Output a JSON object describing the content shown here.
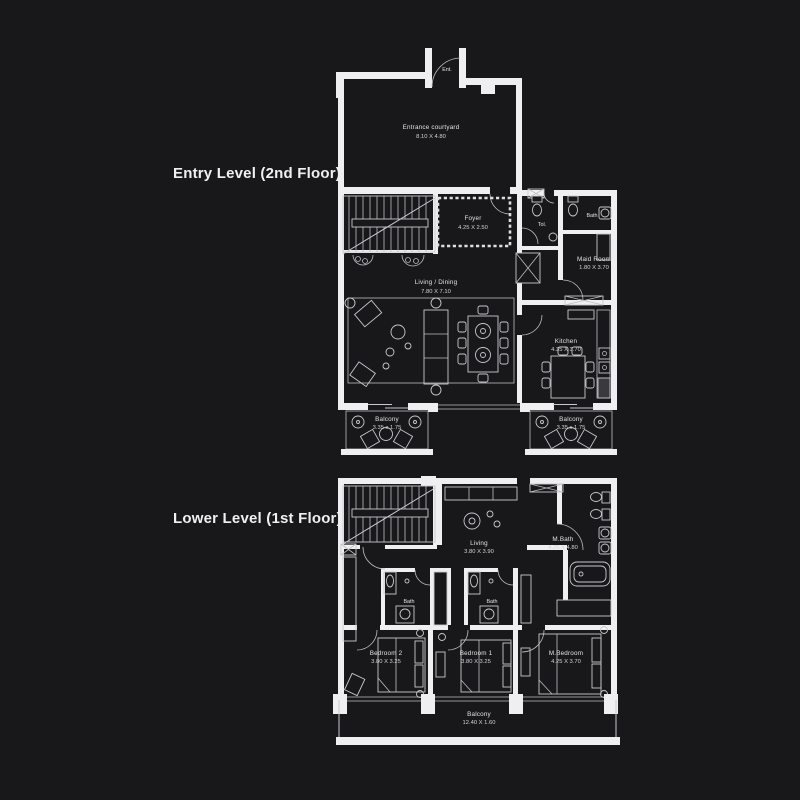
{
  "page": {
    "background": "#18181b",
    "colors": {
      "wall": "#efeff1",
      "line": "#c9c9cd",
      "text": "#e3e3e5"
    }
  },
  "entry": {
    "title": "Entry Level (2nd Floor)",
    "entrance_door": "Ent.",
    "courtyard": {
      "name": "Entrance courtyard",
      "dims": "8.10 X 4.80"
    },
    "foyer": {
      "name": "Foyer",
      "dims": "4.25 X 2.50"
    },
    "toilet": {
      "name": "Tol."
    },
    "bath": {
      "name": "Bath"
    },
    "maid": {
      "name": "Maid Room",
      "dims": "1.80 X 3.70"
    },
    "living": {
      "name": "Living / Dining",
      "dims": "7.80 X 7.10"
    },
    "kitchen": {
      "name": "Kitchen",
      "dims": "4.35 X 3.70"
    },
    "balcony_left": {
      "name": "Balcony",
      "dims": "3.35 x 1.75"
    },
    "balcony_right": {
      "name": "Balcony",
      "dims": "3.35 x 1.75"
    }
  },
  "lower": {
    "title": "Lower Level (1st Floor)",
    "living": {
      "name": "Living",
      "dims": "3.80 X 3.90"
    },
    "mbath": {
      "name": "M.Bath",
      "dims": "4.25 X 4.80"
    },
    "bath1": {
      "name": "Bath"
    },
    "bath2": {
      "name": "Bath"
    },
    "bedroom2": {
      "name": "Bedroom 2",
      "dims": "3.80 X 3.25"
    },
    "bedroom1": {
      "name": "Bedroom 1",
      "dims": "3.80 X 3.25"
    },
    "mbedroom": {
      "name": "M.Bedroom",
      "dims": "4.25 X 3.70"
    },
    "balcony": {
      "name": "Balcony",
      "dims": "12.40 X 1.60"
    }
  }
}
